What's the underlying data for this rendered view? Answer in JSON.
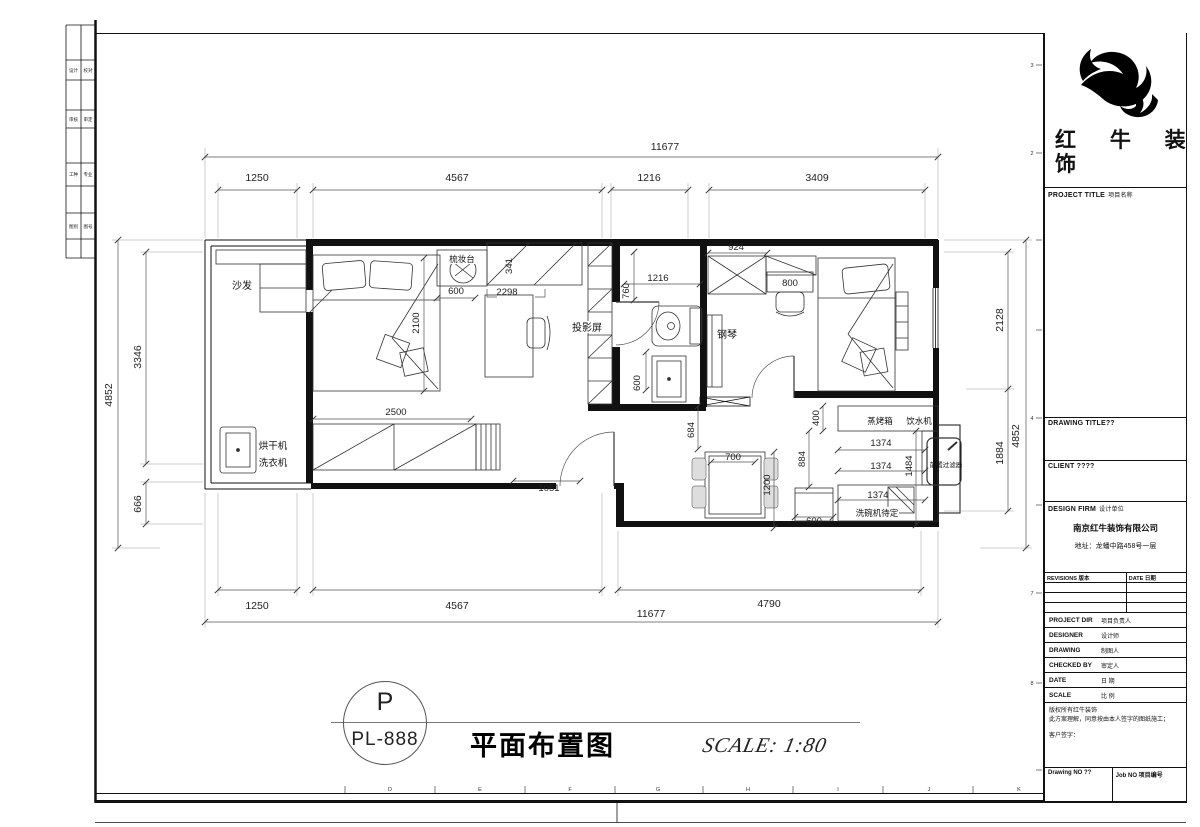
{
  "sheet": {
    "strip_rows": [
      [
        "设计",
        "校对"
      ],
      [
        "审核",
        "审定"
      ],
      [
        "工种",
        "专业"
      ],
      [
        "图别",
        "图号"
      ]
    ],
    "grid_letters": [
      "D",
      "E",
      "F",
      "G",
      "H",
      "I",
      "J",
      "K"
    ],
    "grid_numbers": [
      "3",
      "2",
      "4",
      "7",
      "8"
    ]
  },
  "titleblock": {
    "logo_line1": "红 牛 装",
    "logo_line2": "饰",
    "project_title_en": "PROJECT TITLE",
    "project_title_cn": "项目名称",
    "drawing_title": "DRAWING TITLE??",
    "client": "CLIENT ????",
    "design_firm_en": "DESIGN FIRM",
    "design_firm_cn": "设计单位",
    "company": "南京红牛装饰有限公司",
    "address": "地址：龙蟠中路458号一层",
    "revisions_header": "REVISIONS 版本",
    "date_header": "DATE 日期",
    "rows": [
      {
        "en": "PROJECT DIR",
        "cn": "项目负责人"
      },
      {
        "en": "DESIGNER",
        "cn": "设计师"
      },
      {
        "en": "DRAWING",
        "cn": "制图人"
      },
      {
        "en": "CHECKED BY",
        "cn": "审定人"
      },
      {
        "en": "DATE",
        "cn": "日 期"
      },
      {
        "en": "SCALE",
        "cn": "比 例"
      }
    ],
    "copyright_l1": "版权所有红牛装饰",
    "copyright_l2": "此方案理解，同意按由本人签字的图纸施工；",
    "cop yright_note": "",
    "copyright_l3": "客户签字：",
    "drawing_no": "Drawing NO ??",
    "job_no": "Job NO 项目编号"
  },
  "titlebar": {
    "bubble_letter": "P",
    "bubble_code": "PL-888",
    "drawing_name": "平面布置图",
    "scale_text": "SCALE: 1:80"
  },
  "plan": {
    "labels": {
      "sofa": "沙发",
      "dresser": "梳妆台",
      "projector": "投影屏",
      "piano": "钢琴",
      "dryer": "烘干机",
      "washer": "洗衣机",
      "steam_oven": "蒸烤箱",
      "water_dispenser": "饮水机",
      "prefilter": "前置过滤器",
      "dishwasher": "洗碗机待定"
    },
    "dims": {
      "top_total": "11677",
      "top": [
        "1250",
        "4567",
        "1216",
        "3409"
      ],
      "bottom": [
        "1250",
        "4567",
        "4790"
      ],
      "bottom_total": "11677",
      "left_total": "4852",
      "left": [
        "3346",
        "666"
      ],
      "right": [
        "2128",
        "1884"
      ],
      "right_total": "4852",
      "inner": {
        "bed1": "2100",
        "dresser": "600",
        "desk": "2298",
        "shelf_depth": "341",
        "wardrobe": "2500",
        "entry": "1051",
        "bath_w": "760",
        "bath_l": "1216",
        "closet": "924",
        "shelf": "800",
        "bath_v": "600",
        "k684": "684",
        "k400": "400",
        "k884": "884",
        "k1374a": "1374",
        "k1374b": "1374",
        "k1374c": "1374",
        "k1484": "1484",
        "table_w": "700",
        "table_l": "1200",
        "fridge": "600"
      }
    }
  }
}
